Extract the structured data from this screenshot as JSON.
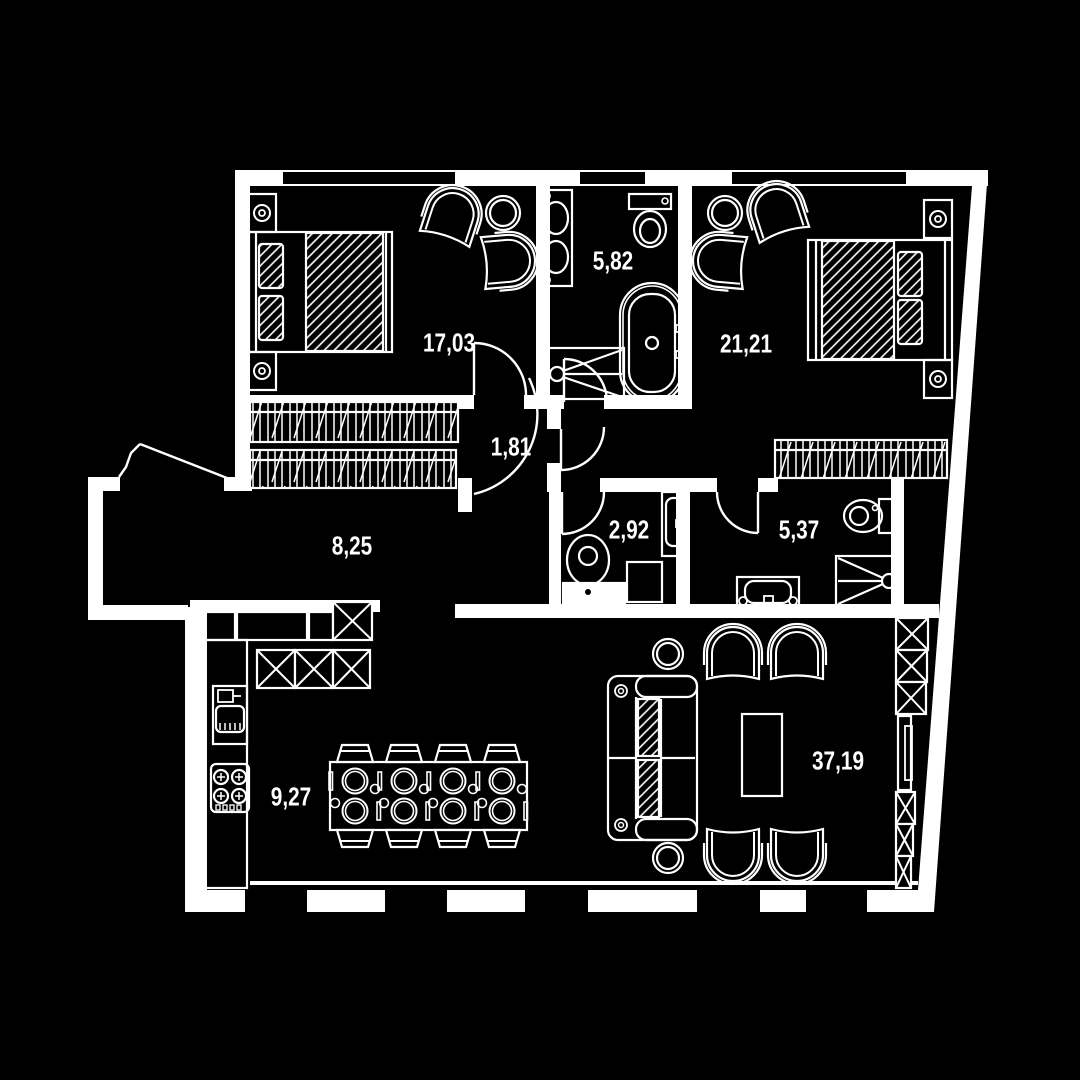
{
  "plan": {
    "colors": {
      "background": "#000000",
      "lines": "#ffffff"
    },
    "rooms": [
      {
        "name": "bedroom-1",
        "area": "17,03"
      },
      {
        "name": "bathroom",
        "area": "5,82"
      },
      {
        "name": "bedroom-2",
        "area": "21,21"
      },
      {
        "name": "hall",
        "area": "1,81"
      },
      {
        "name": "hallway",
        "area": "8,25"
      },
      {
        "name": "wc",
        "area": "2,92"
      },
      {
        "name": "shower-room",
        "area": "5,37"
      },
      {
        "name": "kitchen",
        "area": "9,27"
      },
      {
        "name": "living-room",
        "area": "37,19"
      }
    ]
  }
}
